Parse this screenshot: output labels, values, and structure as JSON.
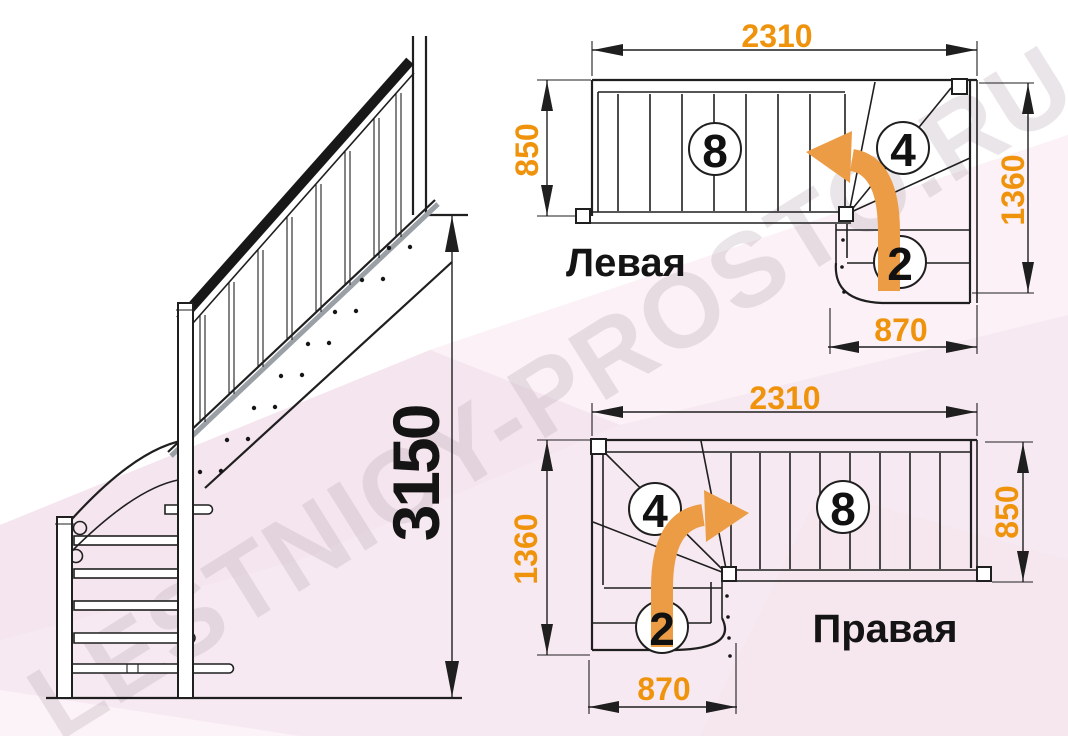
{
  "watermark_text": "LESTNICY-PROSTO.RU",
  "side_view": {
    "total_height": "3150"
  },
  "plan_left": {
    "label": "Левая",
    "width_total": "2310",
    "flight_width": "850",
    "turn_depth": "1360",
    "turn_width": "870",
    "straight_steps": "8",
    "winder_steps": "4",
    "lower_steps": "2"
  },
  "plan_right": {
    "label": "Правая",
    "width_total": "2310",
    "turn_depth": "1360",
    "flight_width": "850",
    "turn_width": "870",
    "straight_steps": "8",
    "winder_steps": "4",
    "lower_steps": "2"
  },
  "colors": {
    "dimension_text": "#F0930C",
    "turn_arrow": "#EC9C45",
    "line": "#1F1F1F",
    "background_tint": "#F7E9F1",
    "watermark": "#BFB0BA"
  }
}
